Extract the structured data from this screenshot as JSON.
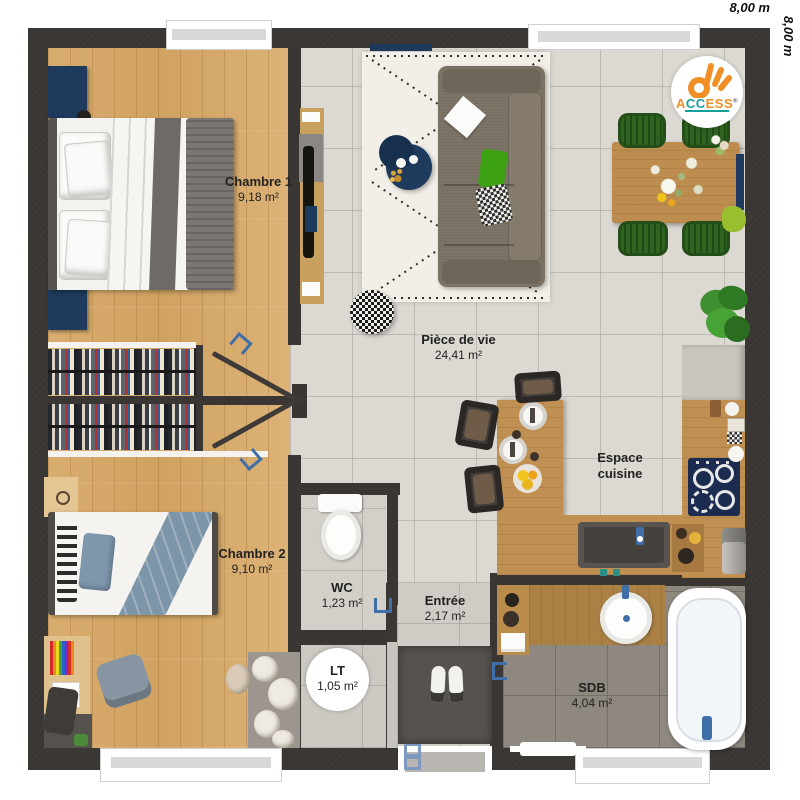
{
  "dimensions": {
    "top": "8,00 m",
    "right": "8,00 m"
  },
  "logo": {
    "brand": "ACCESS",
    "registered": "®",
    "letters": [
      {
        "ch": "A",
        "color": "#ef8f25"
      },
      {
        "ch": "C",
        "color": "#17a09a"
      },
      {
        "ch": "C",
        "color": "#17a09a"
      },
      {
        "ch": "E",
        "color": "#ef8f25"
      },
      {
        "ch": "S",
        "color": "#ef8f25"
      },
      {
        "ch": "S",
        "color": "#ef8f25"
      }
    ]
  },
  "rooms": {
    "chambre1": {
      "name": "Chambre 1",
      "area": "9,18 m²"
    },
    "chambre2": {
      "name": "Chambre 2",
      "area": "9,10 m²"
    },
    "piece_de_vie": {
      "name": "Pièce de vie",
      "area": "24,41 m²"
    },
    "wc": {
      "name": "WC",
      "area": "1,23 m²"
    },
    "entree": {
      "name": "Entrée",
      "area": "2,17 m²"
    },
    "lt": {
      "name": "LT",
      "area": "1,05 m²"
    },
    "sdb": {
      "name": "SDB",
      "area": "4,04 m²"
    },
    "cuisine": {
      "name_line1": "Espace",
      "name_line2": "cuisine"
    }
  },
  "colors": {
    "wall": "#3a3633",
    "wood_floor": "#d7ab6d",
    "living_tile": "#dcd8d2",
    "sdb_tile": "#8e8880",
    "navy_accent": "#1e3a5c",
    "plumbing_blue": "#3f6ea8",
    "logo_orange": "#ef8f25",
    "logo_teal": "#17a09a",
    "chair_green": "#2e6320"
  }
}
